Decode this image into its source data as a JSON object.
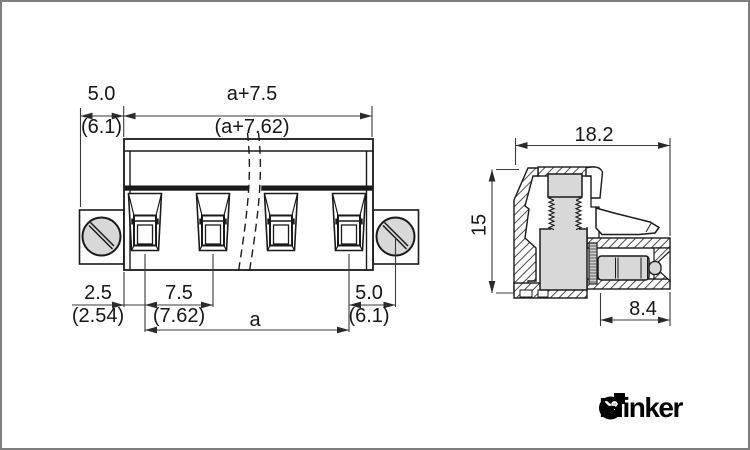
{
  "front_view": {
    "dim_top_left": {
      "value": "5.0",
      "alt": "(6.1)"
    },
    "dim_top_span": {
      "value": "a+7.5",
      "alt": "(a+7.62)"
    },
    "dim_bottom_offset": {
      "value": "2.5",
      "alt": "(2.54)"
    },
    "dim_bottom_pitch": {
      "value": "7.5",
      "alt": "(7.62)"
    },
    "dim_bottom_span": {
      "value": "a"
    },
    "dim_bottom_right": {
      "value": "5.0",
      "alt": "(6.1)"
    }
  },
  "side_view": {
    "dim_width": {
      "value": "18.2"
    },
    "dim_height": {
      "value": "15"
    },
    "dim_pin": {
      "value": "8.4"
    }
  },
  "brand": {
    "name": "Elinker"
  },
  "icons": {
    "logo_icon": "elinker-logo-icon"
  },
  "colors": {
    "line": "#1a1a1a",
    "dim_line": "#3a3a3a",
    "metal_gray": "#d8d8d8",
    "background": "#ffffff",
    "frame_border": "#7e7e7e",
    "logo": "#000000"
  }
}
